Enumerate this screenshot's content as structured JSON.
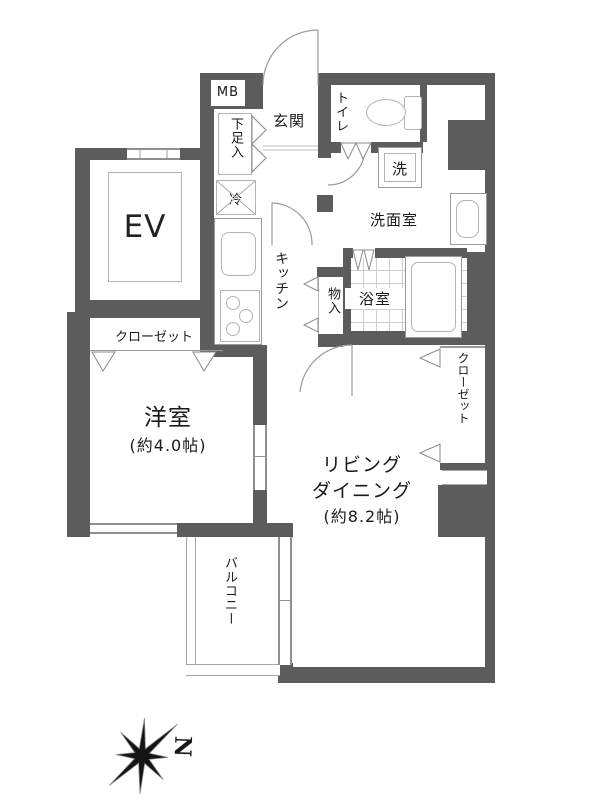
{
  "colors": {
    "wall": "#5c5c5c",
    "thin_line": "#9a9a9a",
    "text": "#1a1a1a"
  },
  "labels": {
    "meter_box": "MB",
    "entrance": "玄関",
    "toilet": "トイレ",
    "shoe_cabinet": "下足入",
    "fridge": "冷",
    "washer": "洗",
    "washroom": "洗面室",
    "kitchen": "キッチン",
    "storage": "物入",
    "bathroom": "浴室",
    "closet_west": "クローゼット",
    "closet_east": "クローゼット",
    "western_room": "洋室",
    "western_room_size": "(約4.0帖)",
    "living_line1": "リビング",
    "living_line2": "ダイニング",
    "living_size": "(約8.2帖)",
    "balcony": "バルコニー",
    "elevator": "EV",
    "compass_north": "N"
  }
}
